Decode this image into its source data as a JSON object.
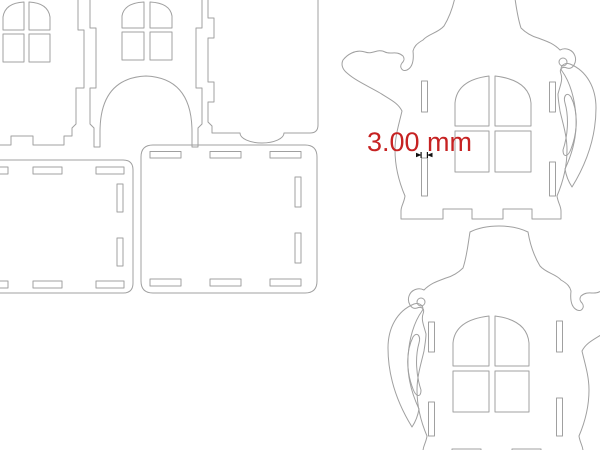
{
  "annotation": {
    "dimension_label": "3.00 mm"
  },
  "colors": {
    "background": "#ffffff",
    "outline": "#a0a0a0",
    "dimension_text": "#c62222",
    "dimension_marker": "#111111"
  },
  "parts": {
    "left_cluster": [
      "house-side-panel-with-arched-window",
      "house-front-panel-with-arched-window-and-door-arch",
      "flat-rectangular-panel-with-thumb-notch",
      "rounded-base-panel-left-with-slots",
      "rounded-base-panel-right-with-slots"
    ],
    "right_cluster": [
      "teapot-side-panel-top",
      "teapot-side-panel-bottom-mirrored"
    ],
    "features": [
      "four-pane-arched-window-cutout",
      "rectangular-tab-slots",
      "jigsaw-finger-joint-edges",
      "castellated-feet",
      "hanging-hole"
    ]
  }
}
